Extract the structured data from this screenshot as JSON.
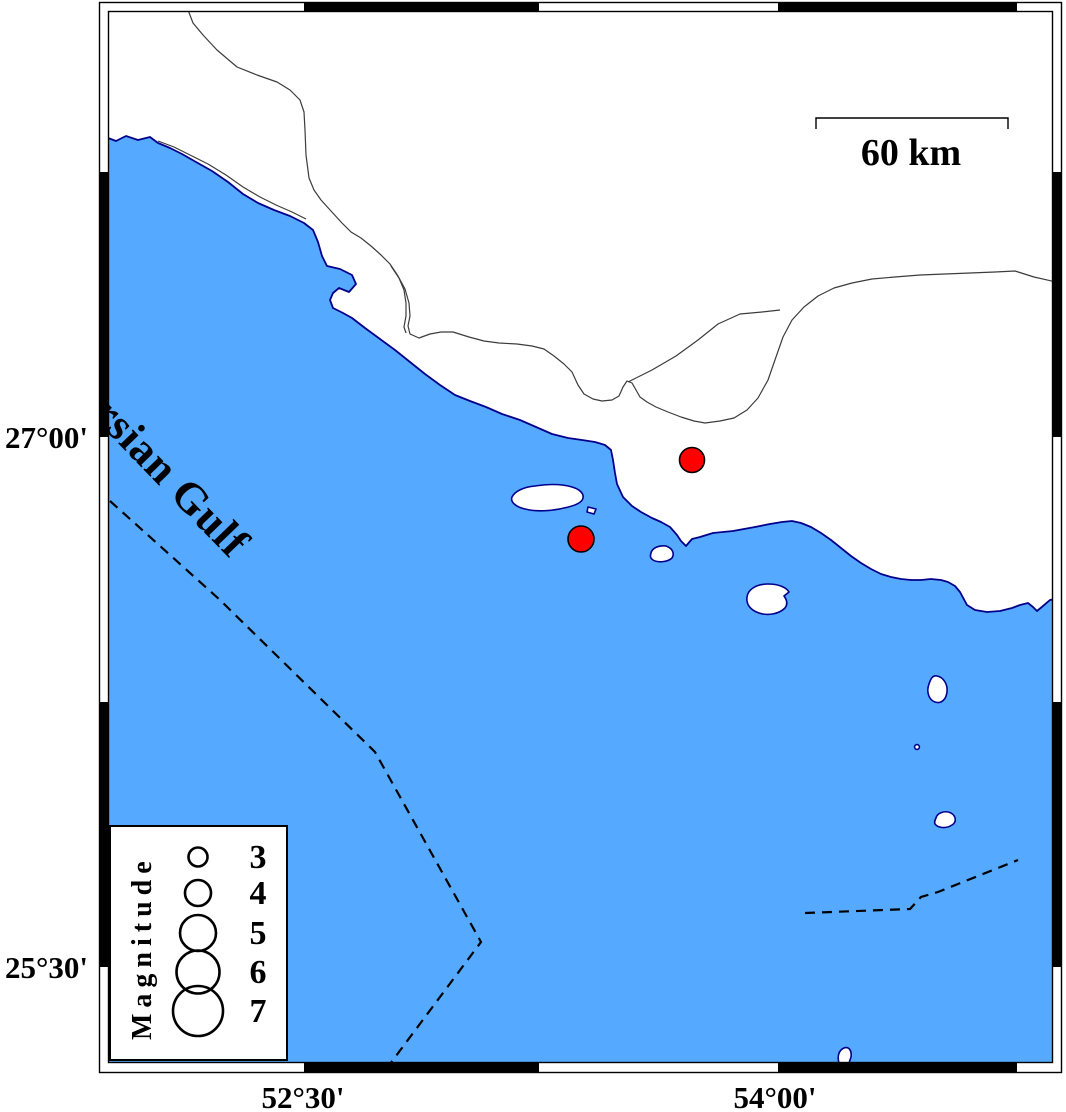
{
  "figure": {
    "type": "seismicity-map",
    "sea_label": "Persian Gulf",
    "scale_bar": {
      "label": "60 km"
    },
    "axis_labels": {
      "left_top": "27°00'",
      "left_bottom": "25°30'",
      "bottom_left": "52°30'",
      "bottom_right": "54°00'"
    },
    "legend": {
      "title": "Magnitude",
      "items": [
        {
          "magnitude": "3",
          "radius": 9.5,
          "cy": 857
        },
        {
          "magnitude": "4",
          "radius": 13,
          "cy": 893
        },
        {
          "magnitude": "5",
          "radius": 18,
          "cy": 933
        },
        {
          "magnitude": "6",
          "radius": 21.5,
          "cy": 972
        },
        {
          "magnitude": "7",
          "radius": 25,
          "cy": 1011
        }
      ]
    },
    "epicenters": [
      {
        "cx": 692,
        "cy": 460,
        "r": 12.5
      },
      {
        "cx": 581,
        "cy": 539,
        "r": 13
      }
    ],
    "colors": {
      "sea": "#55aaff",
      "coastline": "#00008b",
      "epicenter_fill": "#ff0000",
      "border_line": "#3c3c3c"
    }
  }
}
